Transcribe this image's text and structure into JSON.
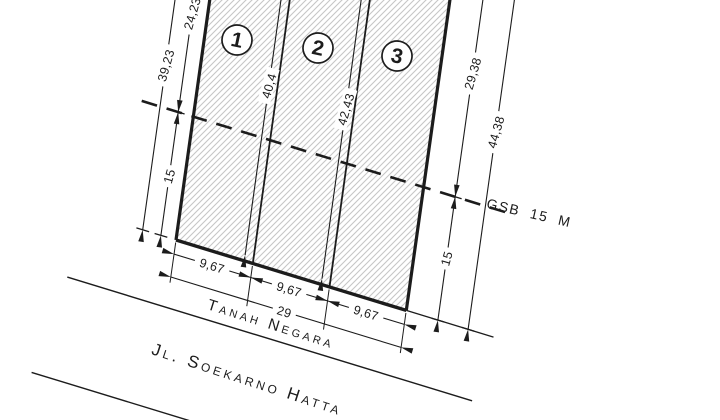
{
  "plan": {
    "plots": [
      {
        "number": "1",
        "frontage": "9,67",
        "depth_label": "40,4"
      },
      {
        "number": "2",
        "frontage": "9,67",
        "depth_label": "42,43"
      },
      {
        "number": "3",
        "frontage": "9,67"
      }
    ],
    "left_dims": {
      "total": "39,23",
      "above_gsb": "24,23",
      "below_gsb": "15"
    },
    "right_dims": {
      "total": "44,38",
      "above_gsb": "29,38",
      "below_gsb": "15"
    },
    "front_total": "29",
    "gsb_text": "GSB 15 M",
    "state_land": "Tanah Negara",
    "road": "Jl. Soekarno Hatta"
  },
  "colors": {
    "ink": "#1c1c1c",
    "hatch": "#c6c6c6",
    "paper": "#ffffff"
  }
}
